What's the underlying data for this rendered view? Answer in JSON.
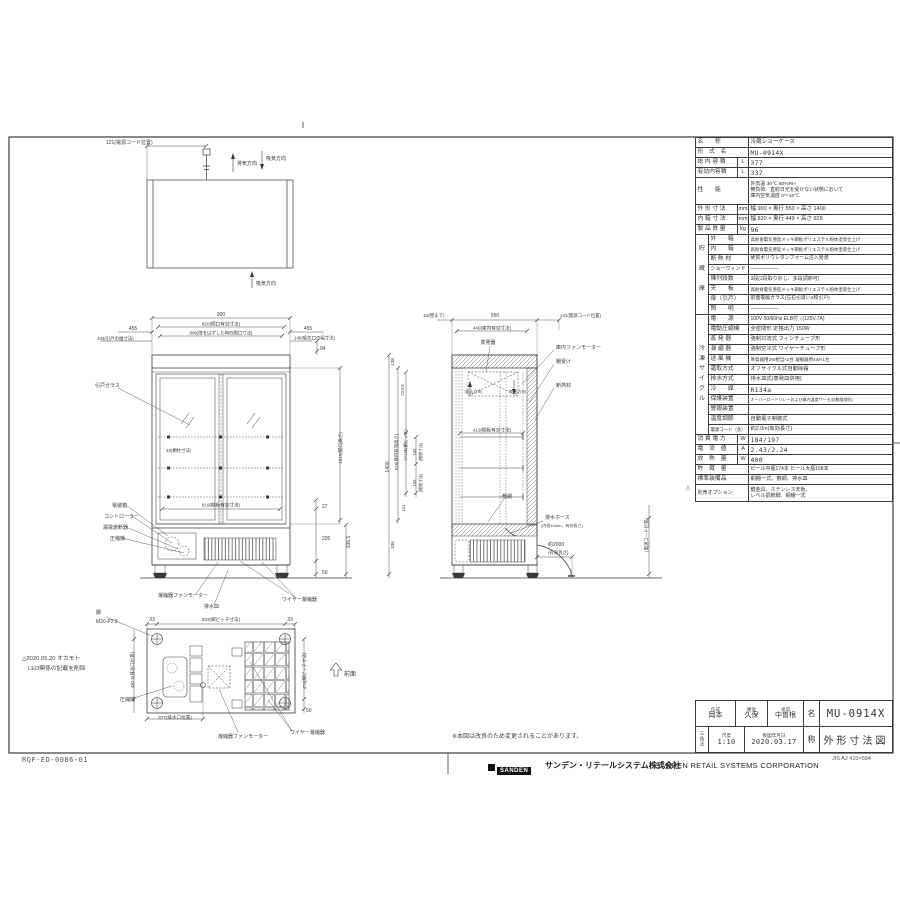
{
  "doc": {
    "drawing_code": "RQF-ED-0086-01",
    "note_change": "※本図は改良のため変更されることがあります。",
    "logo_text": "SANDEN",
    "company_jp": "サンデン・リテールシステム株式会社",
    "company_en": "SANDEN RETAIL SYSTEMS CORPORATION",
    "paper_note": "JIS A2 420×594",
    "revision_line1": "△2020.05.20 オカモト",
    "revision_line2": "LED関係の記載を削除"
  },
  "title_block": {
    "created_label": "作成",
    "created": "岡本",
    "checked_label": "審査",
    "checked": "久保",
    "approved_label": "承認",
    "approved": "中曽根",
    "projection": "三角法",
    "scale_label": "尺度",
    "scale": "1:10",
    "date_label": "製図年月日",
    "date": "2020.03.17",
    "name_label": "名",
    "name": "MU-0914X",
    "title_label": "称",
    "title": "外形寸法図"
  },
  "spec_table": {
    "rows": [
      {
        "l": "名　　称",
        "v": "冷蔵ショーケース"
      },
      {
        "l": "形　式　名",
        "v": "MU-0914X"
      },
      {
        "l": "総 内 容 積",
        "u": "L",
        "v": "377"
      },
      {
        "l": "有効内容積",
        "u": "L",
        "v": "337"
      },
      {
        "l": "性　　能",
        "v": "外気温 30℃ 60%RH\n無負荷、直射日光を受けない状態において\n庫内空気温度 0〜10℃",
        "h": 27,
        "vs": 4.9
      },
      {
        "l": "外 形 寸 法",
        "u": "mm",
        "v": "幅 900 × 奥行 550 × 高さ 1400",
        "vs": 5.5
      },
      {
        "l": "内 箱 寸 法",
        "u": "mm",
        "v": "幅 820 × 奥行 449 × 高さ 928",
        "vs": 5.5
      },
      {
        "l": "製 品 質 量",
        "u": "kg",
        "v": "96"
      },
      {
        "g": "",
        "l": "外　　箱",
        "v": "高耐食電気亜鉛メッキ鋼板ポリエステル粉体塗装仕上げ",
        "vs": 4.4
      },
      {
        "g": "貯",
        "l": "内　　箱",
        "v": "高耐食電気亜鉛メッキ鋼板ポリエステル粉体塗装仕上げ",
        "vs": 4.4
      },
      {
        "g": "",
        "l": "断 熱 材",
        "v": "硬質ポリウレタンフォーム注入発泡",
        "vs": 4.9
      },
      {
        "g": "蔵",
        "l": "ショーウィンド",
        "v": "―――――",
        "ls": 5
      },
      {
        "g": "",
        "l": "陳列段数",
        "v": "3段(2段取り外し、多段調節可)",
        "vs": 5
      },
      {
        "g": "庫",
        "l": "天　　板",
        "v": "高耐食電気亜鉛メッキ鋼板ポリエステル粉体塗装仕上げ",
        "vs": 4.4
      },
      {
        "g": "",
        "l": "扉（引戸）",
        "v": "前面複層ガラス(左右引違い2枚引戸)",
        "vs": 4.9
      },
      {
        "g": "",
        "l": "照　　明",
        "v": "―――――",
        "gb": true
      },
      {
        "g": "",
        "l": "電　　源",
        "v": "100V 50/60Hz ELB付 ○(125V.7A)",
        "vs": 5
      },
      {
        "g": "",
        "l": "電動圧縮機",
        "v": "全密閉形 定格出力 150W",
        "vs": 5.3
      },
      {
        "g": "",
        "l": "蒸 発 器",
        "v": "強制対流式 フィンチューブ形",
        "vs": 5.3
      },
      {
        "g": "冷",
        "l": "凝 縮 器",
        "v": "強制空冷式 ワイヤーチューブ形",
        "vs": 5.3
      },
      {
        "g": "凍",
        "l": "送 風 機",
        "v": "蒸発器用2W相当×2台 凝縮器用4W×1台",
        "vs": 4.5
      },
      {
        "g": "サ",
        "l": "霜取方式",
        "v": "オフサイクル式自動除霜",
        "vs": 5.3
      },
      {
        "g": "イ",
        "l": "排水方式",
        "v": "排水皿式(蒸発皿併用)",
        "vs": 5.3
      },
      {
        "g": "ク",
        "l": "冷　　媒",
        "v": "R134a"
      },
      {
        "g": "ル",
        "l": "保護装置",
        "v": "オーバーロードリレーおよび庫内温度サーモ(自動復帰形)",
        "vs": 4
      },
      {
        "g": "",
        "l": "警報装置",
        "v": ""
      },
      {
        "g": "",
        "l": "温度調節",
        "v": "自動電子制御式",
        "vs": 5.3
      },
      {
        "g": "",
        "l": "電源コード（長）",
        "v": "約2.0m(有効長さ)",
        "ls": 4.4,
        "vs": 5.3,
        "gb": true
      },
      {
        "l": "消 費 電 力",
        "u": "W",
        "v": "184/197"
      },
      {
        "l": "電　流　値",
        "u": "A",
        "v": "2.43/2.24"
      },
      {
        "l": "放　熱　量",
        "u": "W",
        "v": "400"
      },
      {
        "l": "貯　蔵　量",
        "v": "ビール中瓶174本 ビール大瓶168本",
        "vs": 5
      },
      {
        "l": "標準装備品",
        "v": "網棚一式、敷網、排水皿",
        "vs": 5.2
      },
      {
        "l": "別売オプション",
        "v": "鍵金具、ステンレス天板、\nレベル調節脚、網棚一式",
        "h": 17,
        "ls": 5,
        "vs": 5
      }
    ]
  },
  "drawing": {
    "annotations": [
      {
        "t": "121(電源コード位置)",
        "x": 106,
        "y": 144,
        "a": "s"
      },
      {
        "t": "排気方向",
        "x": 237,
        "y": 165,
        "a": "s"
      },
      {
        "t": "吸気方向",
        "x": 266,
        "y": 160,
        "a": "s"
      },
      {
        "t": "吸気方向",
        "x": 256,
        "y": 285,
        "a": "s"
      },
      {
        "t": "900",
        "x": 221,
        "y": 316,
        "a": "m"
      },
      {
        "t": "820(間口有効寸法)",
        "x": 221,
        "y": 325.5,
        "a": "m",
        "s": 4.6
      },
      {
        "t": "809(扉をはずした時の開口寸法)",
        "x": 221,
        "y": 334.5,
        "a": "m",
        "s": 4.4
      },
      {
        "t": "455",
        "x": 133,
        "y": 330,
        "a": "m"
      },
      {
        "t": "344(引戸の幅寸法)",
        "x": 97,
        "y": 340,
        "a": "s",
        "s": 4.4
      },
      {
        "t": "455",
        "x": 308,
        "y": 330,
        "a": "m"
      },
      {
        "t": "140(吸気口の幅寸法)",
        "x": 294,
        "y": 339.5,
        "a": "s",
        "s": 4.4
      },
      {
        "t": "94",
        "x": 320,
        "y": 350,
        "a": "s"
      },
      {
        "t": "引戸ガラス",
        "x": 95,
        "y": 387,
        "a": "s"
      },
      {
        "t": "1015(開口高さ)",
        "x": 342,
        "y": 448,
        "r": -90,
        "a": "m",
        "s": 4.6
      },
      {
        "t": "33(棚柱寸法)",
        "x": 166,
        "y": 452,
        "a": "s",
        "s": 4.4
      },
      {
        "t": "819(棚板有効寸法)",
        "x": 221,
        "y": 506.5,
        "a": "m",
        "s": 4.6
      },
      {
        "t": "電装箱",
        "x": 112,
        "y": 507,
        "a": "s"
      },
      {
        "t": "コントローラー",
        "x": 104,
        "y": 518,
        "a": "s"
      },
      {
        "t": "漏電遮断器",
        "x": 103,
        "y": 529,
        "a": "s"
      },
      {
        "t": "圧縮機",
        "x": 110,
        "y": 540,
        "a": "s"
      },
      {
        "t": "凝縮器ファンモーター",
        "x": 158,
        "y": 597,
        "a": "s"
      },
      {
        "t": "排水皿",
        "x": 204,
        "y": 608,
        "a": "s"
      },
      {
        "t": "ワイヤー凝縮器",
        "x": 282,
        "y": 601,
        "a": "s"
      },
      {
        "t": "27",
        "x": 322,
        "y": 508,
        "a": "s"
      },
      {
        "t": "205",
        "x": 322,
        "y": 540,
        "a": "s"
      },
      {
        "t": "336.5",
        "x": 350,
        "y": 542,
        "r": -90,
        "a": "m"
      },
      {
        "t": "50",
        "x": 322,
        "y": 574,
        "a": "s"
      },
      {
        "t": "53(壁まで)",
        "x": 434,
        "y": 317,
        "a": "m",
        "s": 4.4
      },
      {
        "t": "550",
        "x": 495,
        "y": 317,
        "a": "m"
      },
      {
        "t": "141(電源コード位置)",
        "x": 560,
        "y": 317,
        "a": "s",
        "s": 4.4
      },
      {
        "t": "449(庫内有効寸法)",
        "x": 492,
        "y": 329.5,
        "a": "m",
        "s": 4.6
      },
      {
        "t": "蒸発器",
        "x": 488,
        "y": 344,
        "a": "m"
      },
      {
        "t": "庫内ファンモーター",
        "x": 556,
        "y": 349,
        "a": "s"
      },
      {
        "t": "棚受け",
        "x": 556,
        "y": 363,
        "a": "s"
      },
      {
        "t": "断熱材",
        "x": 556,
        "y": 387,
        "a": "s"
      },
      {
        "t": "吸込方向",
        "x": 465,
        "y": 393,
        "a": "s",
        "s": 4.2
      },
      {
        "t": "吹出方向",
        "x": 509,
        "y": 393,
        "a": "s",
        "s": 4.2
      },
      {
        "t": "138",
        "x": 394,
        "y": 362,
        "r": -90,
        "a": "m",
        "s": 4.6
      },
      {
        "t": "224.5",
        "x": 404,
        "y": 390,
        "r": -90,
        "a": "m",
        "s": 4.6
      },
      {
        "t": "1400",
        "x": 389,
        "y": 467,
        "r": -90,
        "a": "m"
      },
      {
        "t": "928(庫内有効高さ)",
        "x": 398,
        "y": 452,
        "r": -90,
        "a": "m",
        "s": 4.4
      },
      {
        "t": "4×125(棚ピッチ)",
        "x": 407,
        "y": 445,
        "r": -90,
        "a": "m",
        "s": 4.2
      },
      {
        "t": "105",
        "x": 416,
        "y": 452,
        "r": -90,
        "a": "m",
        "s": 4.2
      },
      {
        "t": "(棚間寸法)",
        "x": 422,
        "y": 452,
        "r": -90,
        "a": "m",
        "s": 4
      },
      {
        "t": "105",
        "x": 416,
        "y": 483,
        "r": -90,
        "a": "m",
        "s": 4.2
      },
      {
        "t": "(棚間寸法)",
        "x": 422,
        "y": 483,
        "r": -90,
        "a": "m",
        "s": 4
      },
      {
        "t": "419(棚板有効寸法)",
        "x": 492,
        "y": 431.5,
        "a": "m",
        "s": 4.6
      },
      {
        "t": "111",
        "x": 405,
        "y": 508,
        "r": -90,
        "a": "m",
        "s": 4.6
      },
      {
        "t": "336",
        "x": 394,
        "y": 545,
        "r": -90,
        "a": "m",
        "s": 4.6
      },
      {
        "t": "敷網",
        "x": 502,
        "y": 498,
        "a": "s"
      },
      {
        "t": "排水ホース",
        "x": 545,
        "y": 519,
        "a": "s"
      },
      {
        "t": "(内径15mm、有効長さ)",
        "x": 541,
        "y": 527,
        "a": "s",
        "s": 4
      },
      {
        "t": "約2000",
        "x": 548,
        "y": 546,
        "a": "s"
      },
      {
        "t": "(有効長さ)",
        "x": 548,
        "y": 554,
        "a": "s",
        "s": 4.4
      },
      {
        "t": "(電源コード位置)",
        "x": 648,
        "y": 535,
        "r": -90,
        "a": "m",
        "s": 4.4
      },
      {
        "t": "脚",
        "x": 96,
        "y": 614,
        "a": "s"
      },
      {
        "t": "M20-P2.5",
        "x": 96,
        "y": 623,
        "a": "s"
      },
      {
        "t": "33",
        "x": 152,
        "y": 621,
        "a": "m"
      },
      {
        "t": "833(脚ピッチ寸法)",
        "x": 221,
        "y": 621,
        "a": "m",
        "s": 4.6
      },
      {
        "t": "33",
        "x": 290,
        "y": 621,
        "a": "m"
      },
      {
        "t": "482.5(排水口位置)",
        "x": 134,
        "y": 670,
        "r": -90,
        "a": "m",
        "s": 4.4
      },
      {
        "t": "474(脚ピッチ寸法)",
        "x": 306,
        "y": 671,
        "r": -90,
        "a": "m",
        "s": 4.4
      },
      {
        "t": "50",
        "x": 306,
        "y": 712,
        "a": "s"
      },
      {
        "t": "377(排水口位置)",
        "x": 175,
        "y": 719,
        "a": "m",
        "s": 4.6
      },
      {
        "t": "圧縮機",
        "x": 120,
        "y": 701,
        "a": "s"
      },
      {
        "t": "凝縮器ファンモーター",
        "x": 218,
        "y": 738,
        "a": "s"
      },
      {
        "t": "ワイヤー凝縮器",
        "x": 290,
        "y": 734,
        "a": "s"
      },
      {
        "t": "前面",
        "x": 344,
        "y": 676,
        "a": "s",
        "s": 6
      },
      {
        "t": "△",
        "x": 686,
        "y": 489,
        "a": "s",
        "s": 5
      }
    ]
  }
}
